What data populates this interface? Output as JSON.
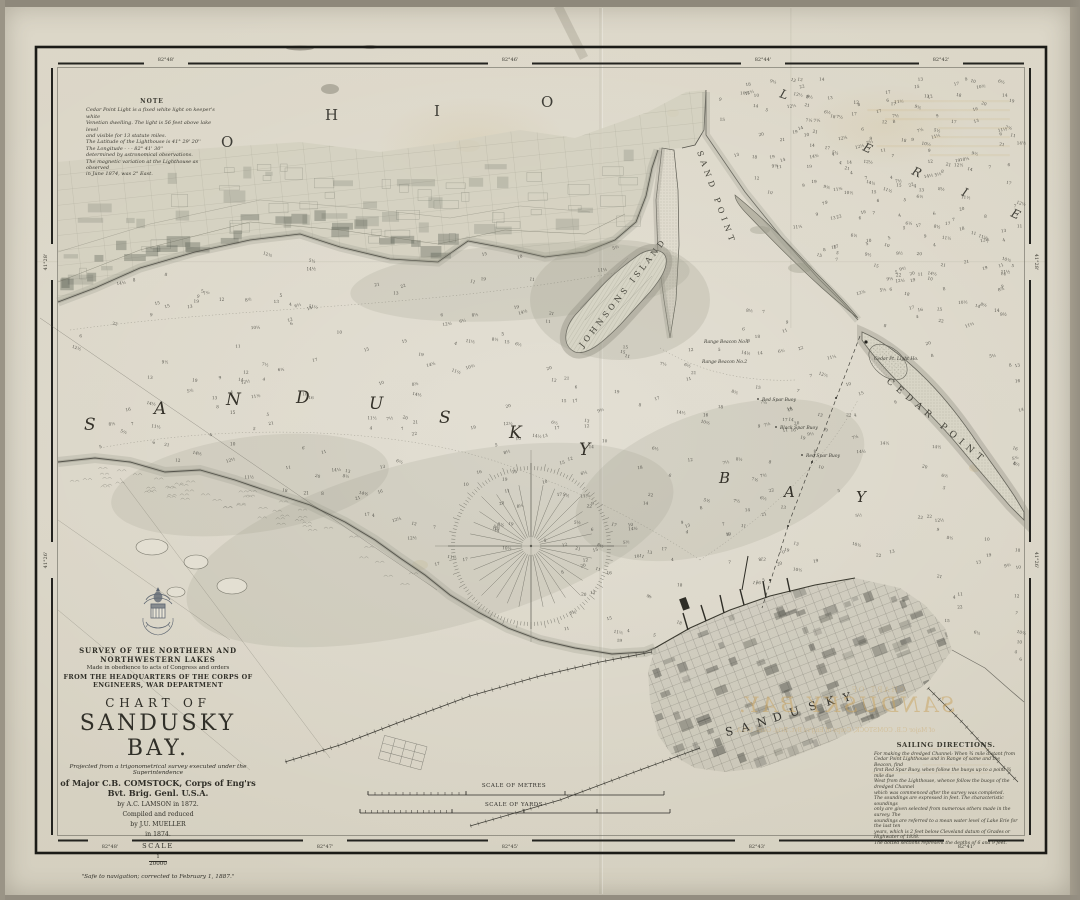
{
  "sheet": {
    "name": "Sandusky Bay nautical chart (1874)"
  },
  "border": {
    "top": [
      "82°48'",
      "82°46'",
      "82°44'",
      "82°42'"
    ],
    "bottom": [
      "82°48'",
      "82°47'",
      "82°45'",
      "82°43'",
      "82°41'"
    ],
    "left": [
      "41°28'",
      "41°26'"
    ],
    "right": [
      "41°28'",
      "41°26'"
    ]
  },
  "note": {
    "heading": "NOTE",
    "lines": [
      "Cedar Point Light is a fixed white light on keeper's white",
      "Venetian dwelling. The light is 56 feet above lake level",
      "and visible for 13 statute miles.",
      "The Latitude of the Lighthouse is   41° 29' 20''",
      "The Longitude   -   -   -   82° 41' 30''",
      "determined by astronomical observations.",
      "The magnetic variation at the Lighthouse as observed",
      "in June 1874, was 2° East."
    ]
  },
  "title_block": {
    "line1": "SURVEY OF THE NORTHERN AND NORTHWESTERN LAKES",
    "line2": "Made in obedience to acts of Congress and orders",
    "line3": "FROM THE HEADQUARTERS OF THE CORPS OF ENGINEERS, WAR DEPARTMENT",
    "chart_of": "CHART OF",
    "title": "SANDUSKY BAY.",
    "projected": "Projected from a trigonometrical survey executed under the Superintendence",
    "major": "of Major C.B. COMSTOCK, Corps of Eng'rs Bvt. Brig. Genl. U.S.A.",
    "by1": "by A.C. LAMSON in 1872.",
    "compiled": "Compiled and reduced",
    "by2": "by J.U. MUELLER",
    "year": "in 1874.",
    "scale_label": "SCALE",
    "scale_num": "1",
    "scale_den": "20000",
    "footnote": "\"Safe to navigation; corrected to February 1, 1887.\""
  },
  "sailing": {
    "heading": "SAILING DIRECTIONS.",
    "lines": [
      "For making the dredged Channel: When ¾ mile distant from",
      "Cedar Point Lighthouse and in Range of same and the Beacon, find",
      "first Red Spar Buoy, when follow the buoys up to a point ¾ mile due",
      "West from the Lighthouse, whence follow the buoys of the dredged Channel",
      "which was commenced after the survey was completed.",
      "The soundings are expressed in feet. The characteristic soundings",
      "only are given selected from numerous others made in the survey. The",
      "soundings are referred to a mean water level of Lake Erie for the last ten",
      "years, which is 2 feet below Cleveland datum of Grades or Highwater of 1838.",
      "The dotted sections represent the depths of 6 and 9 feet."
    ]
  },
  "geo": {
    "ohio": [
      "O",
      "H",
      "I",
      "O"
    ],
    "erie": [
      "L",
      "E",
      "R",
      "I",
      "E"
    ],
    "bay": [
      "S",
      "A",
      "N",
      "D",
      "U",
      "S",
      "K",
      "Y"
    ],
    "bay2": [
      "B",
      "A",
      "Y"
    ],
    "sand_point": "SAND POINT",
    "johnsons_island": "JOHNSONS ISLAND",
    "cedar_point": "CEDAR POINT",
    "city": [
      "S",
      "A",
      "N",
      "D",
      "U",
      "S",
      "K",
      "Y"
    ],
    "lighthouse": "Cedar Pt. Light Ho.",
    "aids": [
      "Range Beacon No.1",
      "Range Beacon No.2",
      "Red Spar Buoy",
      "Black Spar Buoy",
      "Red Spar Buoy"
    ]
  },
  "scales": {
    "metres": "SCALE OF METRES",
    "yards": "SCALE OF YARDS"
  },
  "ghost": {
    "title": "SANDUSKY BAY.",
    "sub": "of Major C.B. COMSTOCK, Corps of Eng'rs Bvt. Brig. Genl. U.S.A."
  },
  "soundings": {
    "count_bay": 330,
    "count_lake": 215,
    "count_east": 16,
    "values": [
      "4",
      "5",
      "5½",
      "6",
      "6½",
      "7",
      "7½",
      "8",
      "8½",
      "9",
      "9½",
      "10",
      "10½",
      "11",
      "11½",
      "12",
      "12½",
      "13",
      "14",
      "14½",
      "15",
      "16",
      "17",
      "18",
      "19",
      "20",
      "21",
      "22"
    ]
  },
  "colors": {
    "ink": "#2b2a26",
    "water_tint": "#97958a",
    "sepia": "#c9a25c"
  }
}
